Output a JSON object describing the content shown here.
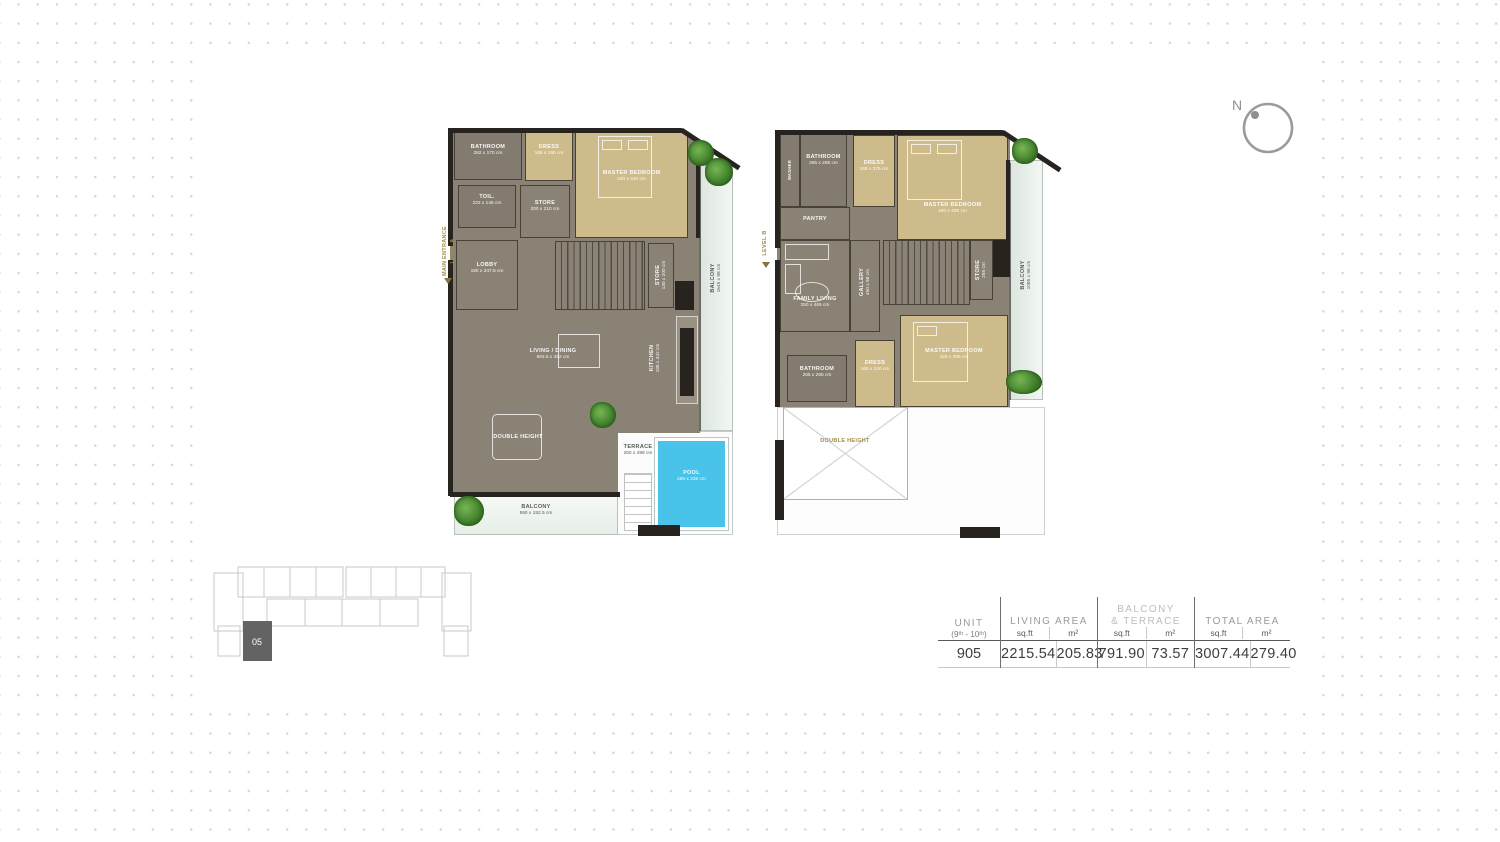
{
  "compass": {
    "north_label": "N"
  },
  "key_plan": {
    "highlighted_unit": "05"
  },
  "plans": {
    "level_a": {
      "entrance": {
        "line1": "MAIN ENTRANCE",
        "line2": "LEVEL A"
      },
      "rooms": {
        "bathroom": {
          "name": "BATHROOM",
          "dims": "262 x 170 cm"
        },
        "dress": {
          "name": "DRESS",
          "dims": "165 x 190 cm"
        },
        "master_bedroom": {
          "name": "MASTER BEDROOM",
          "dims": "400 x 340 cm"
        },
        "toilet": {
          "name": "TOIL.",
          "dims": "222 x 145 cm"
        },
        "store_upper": {
          "name": "STORE",
          "dims": "200 x 210 cm"
        },
        "lobby": {
          "name": "LOBBY",
          "dims": "190 x 347.5 cm"
        },
        "store_stair": {
          "name": "STORE",
          "dims": "130 x 200 cm"
        },
        "kitchen": {
          "name": "KITCHEN",
          "dims": "185 x 342 cm"
        },
        "living_dining": {
          "name": "LIVING / DINING",
          "dims": "683.5 x 482 cm"
        },
        "double_height": {
          "name": "DOUBLE HEIGHT"
        },
        "terrace": {
          "name": "TERRACE",
          "dims": "250 x 498 cm"
        },
        "pool": {
          "name": "POOL",
          "dims": "285 x 335 cm"
        },
        "balcony_bottom": {
          "name": "BALCONY",
          "dims": "590 x 152.5 cm"
        },
        "balcony_right": {
          "name": "BALCONY",
          "dims": "1645 x 98 cm"
        }
      }
    },
    "level_b": {
      "level_label": {
        "line1": "LEVEL B"
      },
      "rooms": {
        "washer": {
          "name": "WASHER"
        },
        "bathroom_upper": {
          "name": "BATHROOM",
          "dims": "265 x 265 cm"
        },
        "dress_upper": {
          "name": "DRESS",
          "dims": "165 x 375 cm"
        },
        "master_upper": {
          "name": "MASTER BEDROOM",
          "dims": "420 x 400 cm"
        },
        "pantry": {
          "name": "PANTRY"
        },
        "family_living": {
          "name": "FAMILY LIVING",
          "dims": "250 x 465 cm"
        },
        "gallery": {
          "name": "GALLERY",
          "dims": "450 x 98 cm"
        },
        "store_stair": {
          "name": "STORE",
          "dims": "255 cm"
        },
        "bathroom_lower": {
          "name": "BATHROOM",
          "dims": "265 x 265 cm"
        },
        "dress_lower": {
          "name": "DRESS",
          "dims": "165 x 240 cm"
        },
        "master_lower": {
          "name": "MASTER BEDROOM",
          "dims": "420 x 355 cm"
        },
        "double_height": {
          "name": "DOUBLE HEIGHT"
        },
        "balcony_right": {
          "name": "BALCONY",
          "dims": "1085 x 98 cm"
        }
      }
    }
  },
  "area_table": {
    "unit": {
      "header": "UNIT",
      "sub": "(9ᵗʰ - 10ᵗʰ)",
      "value": "905"
    },
    "living_area": {
      "header": "LIVING AREA",
      "sqft_label": "sq.ft",
      "m2_label": "m²",
      "sqft": "2215.54",
      "m2": "205.83"
    },
    "balcony_terrace": {
      "header_line1": "BALCONY",
      "header_line2": "& TERRACE",
      "sqft_label": "sq.ft",
      "m2_label": "m²",
      "sqft": "791.90",
      "m2": "73.57"
    },
    "total_area": {
      "header": "TOTAL AREA",
      "sqft_label": "sq.ft",
      "m2_label": "m²",
      "sqft": "3007.44",
      "m2": "279.40"
    }
  }
}
